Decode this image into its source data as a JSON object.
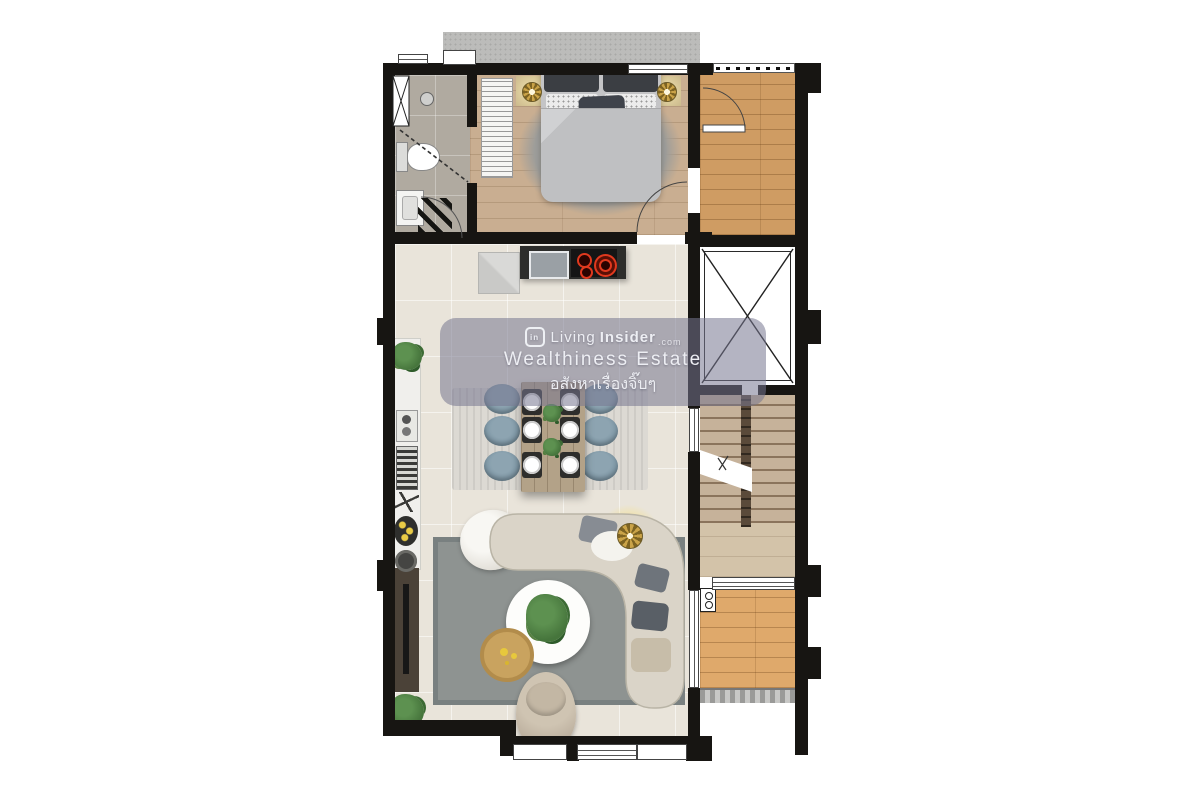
{
  "watermark": {
    "logo_text": "in",
    "brand_prefix": "Living",
    "brand_suffix": "Insider",
    "brand_tld": ".com",
    "title": "Wealthiness Estate",
    "subtitle_thai": "อสังหาเรื่องจิ๊บๆ"
  },
  "palette": {
    "wall": "#171512",
    "floor_tile": "#e9e4da",
    "floor_bedroom": "#c9ae91",
    "floor_balcony": "#cf9c63",
    "floor_deck": "#dfa96b",
    "floor_bath": "#b0aaa0",
    "stair_tread": "#c6b29a",
    "stair_landing": "#d3c3a9",
    "stair_rail": "#5a4a3a",
    "rug_living": "#8e9391",
    "rug_dining": "#dcd9d3",
    "rug_bed": "#9d9d9a",
    "sofa": "#dad4c8",
    "chair_blue": "#7b95a4",
    "table_wood": "#b3a288",
    "counter": "#2d2d2b",
    "burner_red": "#e0391e",
    "awning": "#bcbcba",
    "console_wood": "#4b4238",
    "marble": "#f0efec",
    "plant": "#46753c",
    "gold": "#c09a3e",
    "glow": "#f3dc8e",
    "watermark_bg": "rgba(118,119,143,0.55)",
    "watermark_text": "#edeef3"
  }
}
